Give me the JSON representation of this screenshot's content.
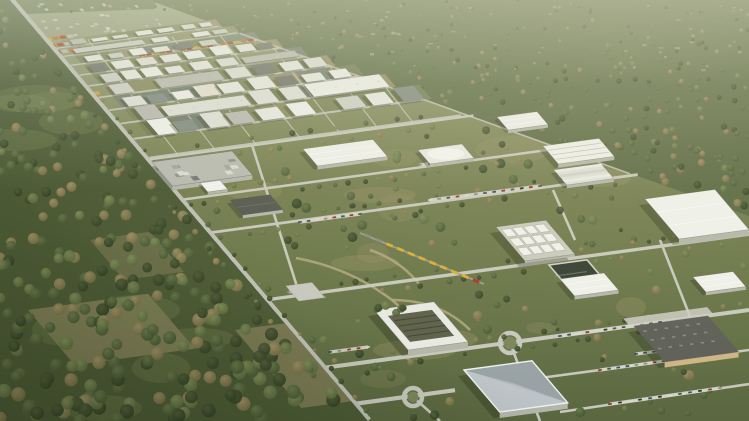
{
  "meta": {
    "title": "Aerial 3D rendering of an industrial park masterplan surrounded by forest",
    "type": "architectural-visualization",
    "view": "oblique aerial"
  },
  "palette": {
    "groundTop": "#9aa183",
    "groundMid": "#7d8557",
    "groundLow": "#6b7749",
    "groundBottom": "#5a6740",
    "parkDry": "#9a9468",
    "forestBase": "#5a6942",
    "forestDark": "#3c4a2c",
    "forestMid": "#57683e",
    "forestLight": "#6e7d4c",
    "forestBrown": "#8d8158",
    "nearForestBase": "#4c5a35",
    "clearing": "#b5b094",
    "roadLight": "#c6c8bc",
    "roadMain": "#bdbfb4",
    "parkingStrip": "#d6d7cc",
    "railDark": "#75766c",
    "railLight": "#a4a596",
    "median": "#5f6b42",
    "white": "#eef0ea",
    "white2": "#e7e9e2",
    "white3": "#dde0d7",
    "roofGray": "#b8bab0",
    "roofMid": "#8f948a",
    "roofDark": "#5d5f57",
    "wallShade": "#b3b6aa",
    "wallShade2": "#a6a99d",
    "plantGray": "#b8bab0",
    "tanWall": "#cdb584",
    "dirtPath": "#b2a87e",
    "dirtField": "#968c66",
    "basin": "#333e30",
    "courtyard": "#5d6049",
    "blueFacet1": "#b7bec2",
    "blueFacet2": "#98a2a6",
    "containerOrange": "#c4682a",
    "containerRed": "#a63c28",
    "containerYellow": "#cfa23a",
    "trainYellow": "#d9ae2e",
    "trainRed": "#aa3526",
    "trainGray": "#8a8a80",
    "shadow": "rgba(25,33,15,0.28)",
    "settleLight": "#d9d9c9",
    "settleMid": "#c2c2b2",
    "settleRoof": "#b7937a",
    "haze": "rgba(210,214,190,0.55)"
  },
  "scene": {
    "canvas": {
      "w": 749,
      "h": 421
    },
    "mainRoad": {
      "x0": 10,
      "dxdy": 0.85,
      "width": 8
    },
    "railOffset": -13,
    "forestEdge": {
      "m": 0.36,
      "b": -55
    },
    "gridBottom": {
      "m": -0.136,
      "b": 180
    },
    "gridRows": [
      56,
      65,
      75,
      86,
      98,
      111,
      125,
      140,
      157
    ],
    "gridStreetTops": [
      50,
      88,
      128,
      172,
      220,
      272,
      330,
      385
    ],
    "crossRoadStarts": [
      160,
      200,
      233,
      300,
      368,
      404
    ],
    "roundabouts": [
      {
        "name": "roundabout-east",
        "x": 510,
        "y": 343,
        "r": 10
      },
      {
        "name": "roundabout-south",
        "x": 413,
        "y": 397,
        "r": 9
      }
    ],
    "train": {
      "x0": 368,
      "y0": 236,
      "x1": 476,
      "y1": 281,
      "cars": 11
    },
    "buildings": [
      {
        "name": "white-hall-north",
        "type": "hall",
        "x": 497,
        "y": 117,
        "w": 40,
        "h": 13
      },
      {
        "name": "barrel-hall",
        "type": "barrel",
        "x": 543,
        "y": 146,
        "w": 56,
        "h": 18
      },
      {
        "name": "white-hall-west",
        "type": "hall",
        "x": 303,
        "y": 149,
        "w": 70,
        "h": 17
      },
      {
        "name": "curved-pavilion",
        "type": "curved",
        "x": 418,
        "y": 150,
        "w": 44,
        "h": 14
      },
      {
        "name": "substation-plant",
        "type": "plant",
        "x": 152,
        "y": 162,
        "w": 80,
        "h": 24
      },
      {
        "name": "terraced-building",
        "type": "terraced",
        "x": 554,
        "y": 170,
        "w": 47,
        "h": 15
      },
      {
        "name": "small-office",
        "type": "hall",
        "x": 200,
        "y": 183,
        "w": 20,
        "h": 9
      },
      {
        "name": "big-hall-east",
        "type": "hall",
        "x": 645,
        "y": 199,
        "w": 70,
        "h": 40
      },
      {
        "name": "dark-roof-hall",
        "type": "hallDark",
        "x": 230,
        "y": 200,
        "w": 40,
        "h": 15
      },
      {
        "name": "equipment-array",
        "type": "array",
        "x": 496,
        "y": 227,
        "w": 50,
        "h": 34
      },
      {
        "name": "water-basin",
        "type": "basin",
        "x": 549,
        "y": 265,
        "w": 38,
        "h": 20
      },
      {
        "name": "east-hall-small",
        "type": "hall",
        "x": 693,
        "y": 277,
        "w": 40,
        "h": 15
      },
      {
        "name": "mid-hall",
        "type": "hall",
        "x": 560,
        "y": 279,
        "w": 44,
        "h": 17
      },
      {
        "name": "parking-lot",
        "type": "lot",
        "x": 286,
        "y": 286,
        "w": 26,
        "h": 15
      },
      {
        "name": "courtyard-campus",
        "type": "court",
        "x": 374,
        "y": 310,
        "w": 60,
        "h": 40
      },
      {
        "name": "dark-roof-factory",
        "type": "factory",
        "x": 634,
        "y": 326,
        "w": 74,
        "h": 36
      },
      {
        "name": "angular-building",
        "type": "angular",
        "x": 464,
        "y": 370,
        "w": 68,
        "h": 42
      }
    ]
  }
}
